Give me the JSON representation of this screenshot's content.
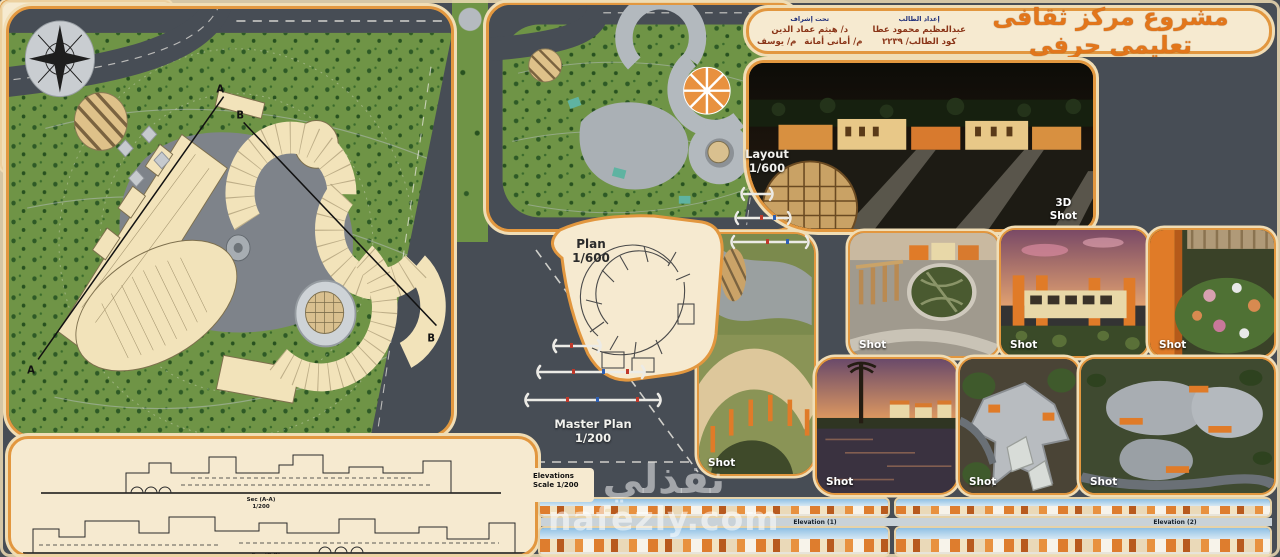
{
  "board": {
    "title": "مشروع مركز ثقافى تعليمى حرفى",
    "credits": {
      "prepared_header": "إعداد الطالب",
      "student_name": "عبدالعظيم محمود عطا",
      "student_code": "كود الطالب/ ٢٢٣٩",
      "supervision_header": "تحت إشراف",
      "supervisor_1": "د/ هيثم عماد الدين",
      "supervisor_2": "م/ أمانى أمانة",
      "supervisor_3": "م/ يوسف"
    }
  },
  "plans": {
    "layout_label": "Layout",
    "layout_scale": "1/600",
    "plan_label": "Plan",
    "plan_scale": "1/600",
    "master_label": "Master Plan",
    "master_scale": "1/200",
    "marker_a": "A",
    "marker_b": "B",
    "sections": {
      "a_label": "Sec (A-A)",
      "a_scale": "1/200",
      "b_label": "Sec (B-B)",
      "b_scale": "1/200"
    },
    "elevations_title": "Elevations",
    "elevations_scale": "Scale 1/200",
    "elevation_1": "Elevation (1)",
    "elevation_2": "Elevation (2)"
  },
  "shots": {
    "shot3d_line1": "3D",
    "shot3d_line2": "Shot",
    "labels": [
      "Shot",
      "Shot",
      "Shot",
      "Shot",
      "Shot",
      "Shot",
      "Shot"
    ]
  },
  "info": {
    "about_title": "نبذة عن المشروع",
    "about_text": "مركز ثقافي تعليمي حرفي هو مؤسسة تجمع بين الأبعاد الثقافية والتعليمية والحرفية، يهدف إلى تعزيز الوعي الثقافي ونشر المعرفة وتنمية المهارات الحرفية والفنية لدى أفراد المجتمع من خلال قاعات تعليمية وورش حرفية ومعارض دائمة تخدم المنطقة المحيطة وتحافظ على الحرف التراثية من الاندثار.",
    "goals_title": "أهداف المشروع",
    "goals_text": "١- إنشاء مبنى يجمع الطلاب لتعلم الحرف في مكان واحد.  ٢- توفير فرص عمل وتحسين المستوى الاقتصادي.  ٣- تعزيز الانتماء الثقافي في المنطقة.  ٤- تشجيع الشباب على تعلم الحرف اليدوية والحفاظ عليها من الاندثار.  ٥- توفير قاعات للتدريب والعرض وممارسة الأنشطة الثقافية.  ٦- تنمية الجانب الإبداعي لدى الزوار.",
    "site_title": "أسباب اختيار الموقع",
    "site_text": "١- الموقع المركزي على الطريق الرئيسي للمنطقة مما يجعله مركزاً لتجميع الحرف.  ٢- الجوار المحيط من مناطق سكنية وتعليمية وخدمية يخدم المشروع.  ٣- سهولة الوصول إلى الموقع من المحاور الرئيسية وتوافر المساحة اللازمة لأنشطة المشروع.",
    "diagram_titles": [
      "الموقع العام",
      "تحليل الموقع",
      "دراسة الموقع"
    ],
    "stages_title": "مراحل تطور المشروع"
  },
  "watermark": {
    "arabic": "نفذلي",
    "latin": "nafezly.com"
  },
  "colors": {
    "accent_orange": "#e2973f",
    "cream": "#f6ead0",
    "title_orange": "#e2761b",
    "grass_green": "#6f9446",
    "road_dark": "#474d55",
    "building_cream": "#f2e3ba"
  }
}
